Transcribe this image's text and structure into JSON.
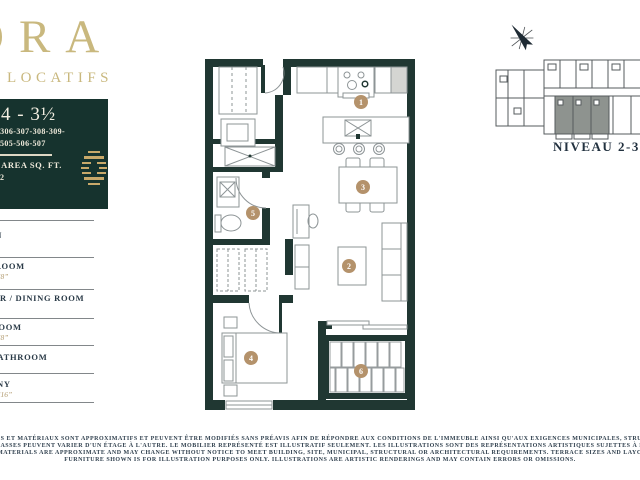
{
  "brand": {
    "name": "ORA",
    "tagline": "LOCATIFS"
  },
  "unit_card": {
    "title": "4 - 3½",
    "units_line1": "-306-307-308-309-",
    "units_line2": "505-506-507",
    "area_line": "7 AREA SQ. FT.",
    "area_note": "2"
  },
  "legend": {
    "rooms": [
      {
        "name": "CUISINE / KITCHEN",
        "dim": ""
      },
      {
        "name": "SALON / LIVING ROOM",
        "dim": "’8”"
      },
      {
        "name": "SALLE À MANGER / DINING ROOM",
        "dim": ""
      },
      {
        "name": "CHAMBRE / BEDROOM",
        "dim": "’8”"
      },
      {
        "name": "SALLE DE BAIN / BATHROOM",
        "dim": ""
      },
      {
        "name": "BALCON / BALCONY",
        "dim": "’16”"
      }
    ]
  },
  "plan": {
    "markers": [
      "1",
      "2",
      "3",
      "4",
      "5",
      "6"
    ]
  },
  "keyplan": {
    "level_label": "NIVEAU 2-3-4"
  },
  "disclaimer": {
    "line1": "S, CARACTÉRISTIQUES ET MATÉRIAUX SONT APPROXIMATIFS ET PEUVENT ÊTRE MODIFIÉS SANS PRÉAVIS AFIN DE RÉPONDRE AUX CONDITIONS DE L'IMMEUBLE AINSI QU'AUX EXIGENCES MUNICIPALES, STRUCTURALES ET ARCHI",
    "line2": "ISPOSITION DES TERRASSES PEUVENT VARIER D'UN ÉTAGE À L'AUTRE. LE MOBILIER REPRÉSENTÉ EST ILLUSTRATIF SEULEMENT. LES ILLUSTRATIONS SONT DES REPRÉSENTATIONS ARTISTIQUES SUJETTES À ERREURS OU OMISSIO",
    "line3": "ECIFICATIONS AND MATERIALS ARE APPROXIMATE AND MAY CHANGE WITHOUT NOTICE TO MEET BUILDING, SITE, MUNICIPAL, STRUCTURAL OR ARCHITECTURAL REQUIREMENTS. TERRACE SIZES AND LAYOUTS MAY DIFFER BE",
    "line4": "FURNITURE SHOWN IS FOR ILLUSTRATION PURPOSES ONLY. ILLUSTRATIONS ARE ARTISTIC RENDERINGS AND MAY CONTAIN ERRORS OR OMISSIONS."
  },
  "colors": {
    "gold": "#c9b87e",
    "tan": "#b4926b",
    "teal": "#16332e",
    "ink": "#2a3a47"
  }
}
